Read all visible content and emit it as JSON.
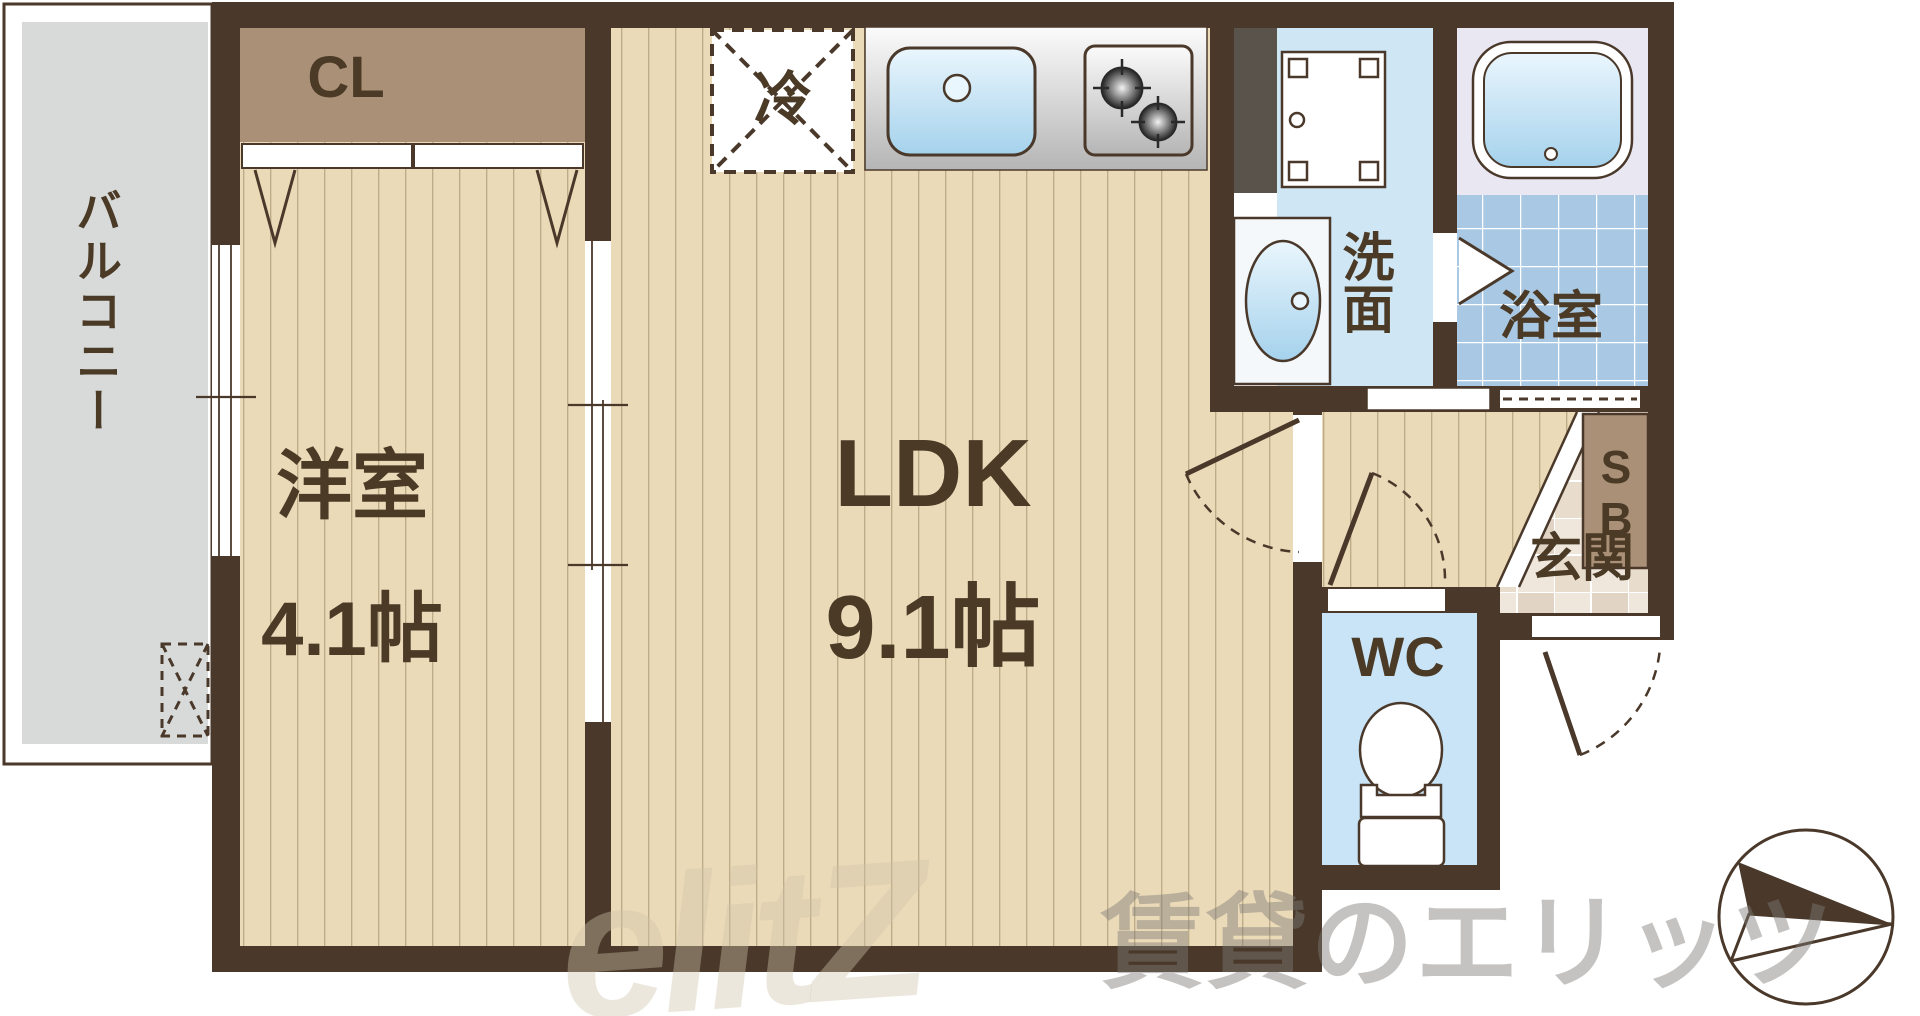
{
  "plan": {
    "balcony": {
      "label": "バルコニー"
    },
    "closet": {
      "label": "CL"
    },
    "western_room": {
      "label": "洋室",
      "size": "4.1帖"
    },
    "ldk": {
      "label": "LDK",
      "size": "9.1帖"
    },
    "refrigerator": {
      "label": "冷"
    },
    "washroom": {
      "label": "洗面"
    },
    "bathroom": {
      "label": "浴室"
    },
    "toilet": {
      "label": "WC"
    },
    "entrance": {
      "label": "玄関"
    },
    "shoebox": {
      "label": "SB"
    }
  },
  "watermark": {
    "logo": "elitZ",
    "text": "賃貸のエリッツ"
  },
  "colors": {
    "wall": "#4a392a",
    "wood_floor": "#ebdab8",
    "closet_tan": "#ab9078",
    "balcony_gray": "#d7dad9",
    "washroom_blue": "#cfe6f4",
    "wc_blue": "#c8e4f6",
    "bath_tile": "#a9c8e3",
    "bath_floor": "#e9e7f2",
    "entrance_tile": "#ece3d7",
    "pipe_space": "#5a534b",
    "text": "#4a3a26"
  }
}
